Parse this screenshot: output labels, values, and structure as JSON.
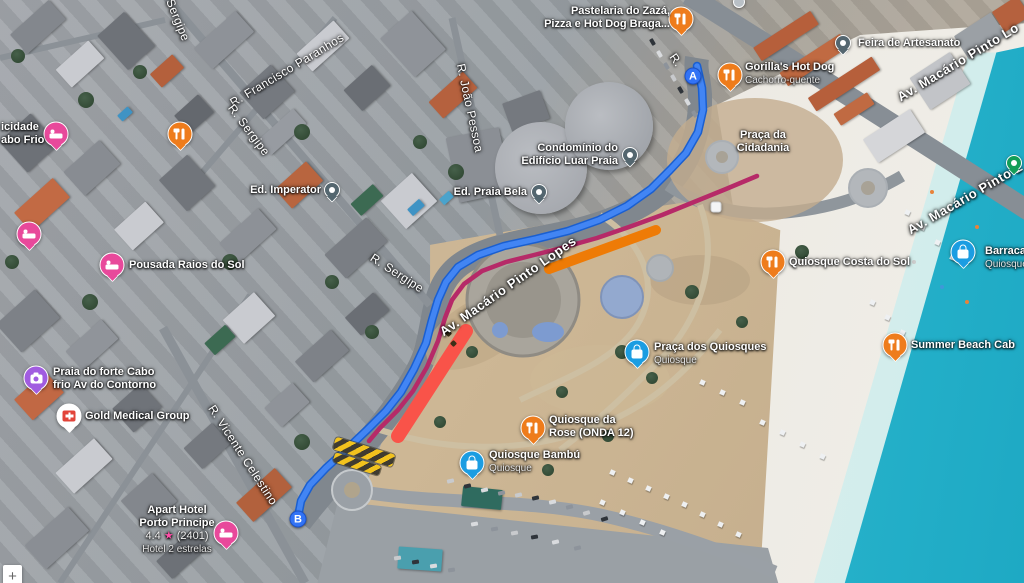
{
  "map_type": "satellite",
  "controls": {
    "zoom_in": "+"
  },
  "route": {
    "start": {
      "label": "A",
      "x": 693,
      "y": 76
    },
    "end": {
      "label": "B",
      "x": 298,
      "y": 519
    },
    "color": "#4285f4",
    "casing_color": "#1a5fd0",
    "points": [
      [
        697,
        66
      ],
      [
        702,
        88
      ],
      [
        703,
        110
      ],
      [
        698,
        132
      ],
      [
        686,
        153
      ],
      [
        670,
        170
      ],
      [
        651,
        189
      ],
      [
        627,
        206
      ],
      [
        599,
        220
      ],
      [
        568,
        231
      ],
      [
        536,
        239
      ],
      [
        504,
        246
      ],
      [
        478,
        255
      ],
      [
        458,
        267
      ],
      [
        446,
        282
      ],
      [
        438,
        300
      ],
      [
        432,
        320
      ],
      [
        426,
        343
      ],
      [
        414,
        369
      ],
      [
        401,
        392
      ],
      [
        386,
        411
      ],
      [
        367,
        430
      ],
      [
        346,
        450
      ],
      [
        326,
        468
      ],
      [
        310,
        485
      ],
      [
        301,
        501
      ],
      [
        298,
        517
      ]
    ],
    "traffic": {
      "heavy_color": "#b62a68",
      "jam_color": "#f95349",
      "closure_color": "#ee7b06",
      "heavy_points": [
        [
          757,
          176
        ],
        [
          726,
          189
        ],
        [
          694,
          202
        ],
        [
          662,
          215
        ],
        [
          629,
          227
        ],
        [
          597,
          238
        ],
        [
          565,
          247
        ],
        [
          534,
          255
        ],
        [
          506,
          262
        ],
        [
          482,
          271
        ],
        [
          464,
          284
        ],
        [
          452,
          300
        ],
        [
          445,
          318
        ],
        [
          438,
          341
        ],
        [
          427,
          367
        ],
        [
          413,
          391
        ],
        [
          398,
          410
        ],
        [
          380,
          428
        ],
        [
          369,
          441
        ]
      ],
      "jam_segment": [
        [
          466,
          331
        ],
        [
          398,
          436
        ]
      ],
      "closure_segment": [
        [
          549,
          269
        ],
        [
          656,
          230
        ]
      ],
      "construction_hatch_present": true
    }
  },
  "pois": [
    {
      "id": "pastelaria",
      "icon": "restaurant",
      "x": 681,
      "y": 19,
      "label": {
        "align": "right",
        "x": 670,
        "y": 5,
        "lines": [
          "Pastelaria do Zazá,",
          "Pizza e Hot Dog Braga..."
        ],
        "muted": []
      }
    },
    {
      "id": "unlabeled-dot",
      "icon": "smalldot",
      "x": 739,
      "y": 2
    },
    {
      "id": "gorillas-hot-dog",
      "icon": "restaurant",
      "x": 730,
      "y": 75,
      "label": {
        "align": "left",
        "x": 745,
        "y": 61,
        "lines": [
          "Gorilla's Hot Dog",
          "Cachorro-quente"
        ],
        "muted": [
          1
        ]
      }
    },
    {
      "id": "feira-artesanato",
      "icon": "building",
      "x": 843,
      "y": 43,
      "label": {
        "align": "left",
        "x": 858,
        "y": 37,
        "lines": [
          "Feira de Artesanato"
        ],
        "muted": []
      }
    },
    {
      "id": "praca-da-cidadania",
      "icon": "none",
      "label": {
        "align": "center",
        "x": 763,
        "y": 129,
        "lines": [
          "Praça da",
          "Cidadania"
        ],
        "muted": []
      }
    },
    {
      "id": "park-pin",
      "icon": "park",
      "x": 1014,
      "y": 163
    },
    {
      "id": "transit-stop",
      "icon": "transit",
      "x": 716,
      "y": 207
    },
    {
      "id": "barraca",
      "icon": "kiosk",
      "x": 963,
      "y": 252,
      "label": {
        "align": "left",
        "x": 985,
        "y": 245,
        "lines": [
          "Barraca",
          "Quiosque"
        ],
        "muted": [
          1
        ]
      }
    },
    {
      "id": "quiosque-costa-do-sol",
      "icon": "restaurant",
      "x": 773,
      "y": 262,
      "label": {
        "align": "left",
        "x": 789,
        "y": 256,
        "lines": [
          "Quiosque Costa do Sol"
        ],
        "muted": []
      }
    },
    {
      "id": "summer-beach",
      "icon": "restaurant",
      "x": 895,
      "y": 345,
      "label": {
        "align": "left",
        "x": 911,
        "y": 339,
        "lines": [
          "Summer Beach Cab"
        ],
        "muted": []
      }
    },
    {
      "id": "praca-dos-quiosques",
      "icon": "kiosk",
      "x": 637,
      "y": 352,
      "label": {
        "align": "left",
        "x": 654,
        "y": 341,
        "lines": [
          "Praça dos Quiosques",
          "Quiosque"
        ],
        "muted": [
          1
        ]
      }
    },
    {
      "id": "quiosque-da-rose",
      "icon": "restaurant",
      "x": 533,
      "y": 428,
      "label": {
        "align": "left",
        "x": 549,
        "y": 414,
        "lines": [
          "Quiosque da",
          "Rose (ONDA 12)"
        ],
        "muted": []
      }
    },
    {
      "id": "quiosque-bambu",
      "icon": "kiosk",
      "x": 472,
      "y": 463,
      "label": {
        "align": "left",
        "x": 489,
        "y": 449,
        "lines": [
          "Quiosque Bambú",
          "Quiosque"
        ],
        "muted": [
          1
        ]
      }
    },
    {
      "id": "ed-imperator",
      "icon": "building",
      "x": 332,
      "y": 190,
      "label": {
        "align": "right",
        "x": 321,
        "y": 184,
        "lines": [
          "Ed. Imperator"
        ],
        "muted": []
      }
    },
    {
      "id": "ed-praia-bela",
      "icon": "building",
      "x": 539,
      "y": 192,
      "label": {
        "align": "right",
        "x": 527,
        "y": 186,
        "lines": [
          "Ed. Praia Bela"
        ],
        "muted": []
      }
    },
    {
      "id": "condominio-luar-praia",
      "icon": "building",
      "x": 630,
      "y": 155,
      "label": {
        "align": "right",
        "x": 618,
        "y": 142,
        "lines": [
          "Condomínio do",
          "Edifício Luar Praia"
        ],
        "muted": []
      }
    },
    {
      "id": "pousada-raios-do-sol",
      "icon": "hotel",
      "x": 112,
      "y": 265,
      "label": {
        "align": "left",
        "x": 129,
        "y": 259,
        "lines": [
          "Pousada Raios do Sol"
        ],
        "muted": []
      }
    },
    {
      "id": "hotel-pin-unlabeled",
      "icon": "hotel",
      "x": 29,
      "y": 234
    },
    {
      "id": "restaurant-pin-unlabeled",
      "icon": "restaurant",
      "x": 180,
      "y": 134
    },
    {
      "id": "felicidade-clipped",
      "icon": "hotel",
      "x": 56,
      "y": 134,
      "label": {
        "align": "left",
        "x": 1,
        "y": 121,
        "lines": [
          "icidade",
          "abo Frio"
        ],
        "muted": []
      }
    },
    {
      "id": "praia-do-forte",
      "icon": "attraction",
      "x": 36,
      "y": 378,
      "label": {
        "align": "left",
        "x": 53,
        "y": 366,
        "lines": [
          "Praia do forte Cabo",
          "frio Av do Contorno"
        ],
        "muted": []
      }
    },
    {
      "id": "gold-medical-group",
      "icon": "medical",
      "x": 69,
      "y": 416,
      "label": {
        "align": "left",
        "x": 85,
        "y": 410,
        "lines": [
          "Gold Medical Group"
        ],
        "muted": []
      }
    },
    {
      "id": "apart-hotel-porto-principe",
      "icon": "hotel",
      "x": 226,
      "y": 533,
      "label": {
        "align": "center",
        "x": 177,
        "y": 504,
        "lines": [
          "Apart Hotel",
          "Porto Principe"
        ],
        "muted": [],
        "rating": {
          "value": "4.4",
          "star": "★",
          "reviews": "(2401)"
        },
        "category": "Hotel 2 estrelas"
      }
    }
  ],
  "street_labels": [
    {
      "text": "Sergipe",
      "x": 178,
      "y": 20,
      "rot": 68,
      "size": 12,
      "bold": false
    },
    {
      "text": "R. Francisco Paranhos",
      "x": 287,
      "y": 70,
      "rot": -31,
      "size": 12,
      "bold": false
    },
    {
      "text": "R. João Pessoa",
      "x": 470,
      "y": 108,
      "rot": 78,
      "size": 12,
      "bold": false
    },
    {
      "text": "R. Sergipe",
      "x": 249,
      "y": 130,
      "rot": 53,
      "size": 12,
      "bold": false
    },
    {
      "text": "R. Sergipe",
      "x": 397,
      "y": 273,
      "rot": 33,
      "size": 12,
      "bold": false
    },
    {
      "text": "R. Vicente Celestino",
      "x": 243,
      "y": 455,
      "rot": 57,
      "size": 12,
      "bold": false
    },
    {
      "text": "R.",
      "x": 676,
      "y": 60,
      "rot": 55,
      "size": 12,
      "bold": false
    },
    {
      "text": "Av. Macário Pinto Lo",
      "x": 958,
      "y": 62,
      "rot": -31,
      "size": 13,
      "bold": true
    },
    {
      "text": "Av. Macário Pinto L",
      "x": 965,
      "y": 198,
      "rot": -30,
      "size": 13,
      "bold": true
    },
    {
      "text": "Av. Macário Pinto Lopes",
      "x": 508,
      "y": 286,
      "rot": -35,
      "size": 13,
      "bold": true
    }
  ]
}
